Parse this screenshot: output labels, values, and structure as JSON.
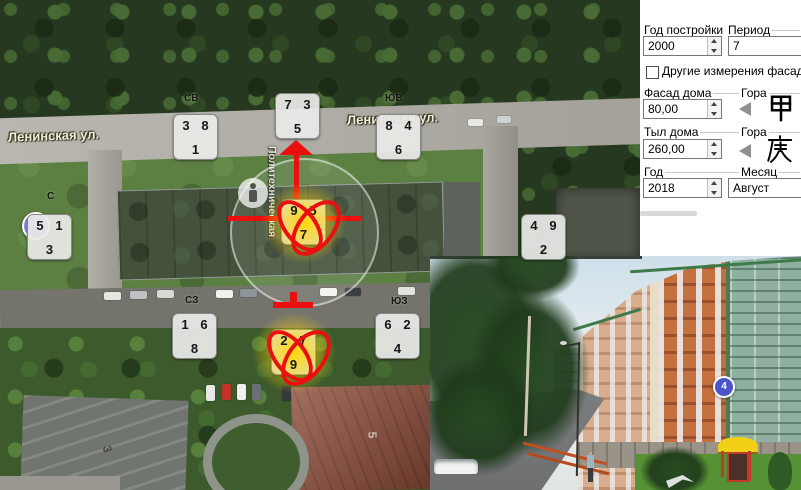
{
  "panel": {
    "year_built": {
      "label": "Год постройки",
      "value": "2000"
    },
    "period": {
      "label": "Период",
      "value": "7"
    },
    "other_measurements": {
      "label": "Другие измерения фасада",
      "checked": false
    },
    "facade": {
      "label": "Фасад дома",
      "value": "80,00"
    },
    "facade_mountain": {
      "label": "Гора",
      "hanzi": "甲"
    },
    "rear": {
      "label": "Тыл дома",
      "value": "260,00"
    },
    "rear_mountain": {
      "label": "Гора",
      "hanzi": "庚"
    },
    "year": {
      "label": "Год",
      "value": "2018"
    },
    "month": {
      "label": "Месяц",
      "value": "Август"
    }
  },
  "map": {
    "street_labels": {
      "left": "Ленинская ул.",
      "right": "Ленинская ул.",
      "vertical": "Политехническая"
    },
    "house_numbers": {
      "left": "3",
      "right": "5"
    },
    "sector_labels": [
      {
        "text": "СВ",
        "x": 184,
        "y": 93
      },
      {
        "text": "ЮВ",
        "x": 385,
        "y": 93
      },
      {
        "text": "С",
        "x": 47,
        "y": 191
      },
      {
        "text": "СЗ",
        "x": 185,
        "y": 295
      },
      {
        "text": "ЮЗ",
        "x": 391,
        "y": 296
      }
    ],
    "star_grids": [
      {
        "tl": "3",
        "tr": "8",
        "b": "1",
        "x": 173,
        "y": 114,
        "highlighted": false
      },
      {
        "tl": "7",
        "tr": "3",
        "b": "5",
        "x": 275,
        "y": 93,
        "highlighted": false
      },
      {
        "tl": "8",
        "tr": "4",
        "b": "6",
        "x": 376,
        "y": 114,
        "highlighted": false
      },
      {
        "tl": "5",
        "tr": "1",
        "b": "3",
        "x": 27,
        "y": 214,
        "highlighted": false
      },
      {
        "tl": "9",
        "tr": "5",
        "b": "7",
        "x": 281,
        "y": 199,
        "highlighted": true
      },
      {
        "tl": "4",
        "tr": "9",
        "b": "2",
        "x": 521,
        "y": 214,
        "highlighted": false
      },
      {
        "tl": "1",
        "tr": "6",
        "b": "8",
        "x": 172,
        "y": 313,
        "highlighted": false
      },
      {
        "tl": "2",
        "tr": "7",
        "b": "9",
        "x": 271,
        "y": 329,
        "highlighted": true
      },
      {
        "tl": "6",
        "tr": "2",
        "b": "4",
        "x": 375,
        "y": 313,
        "highlighted": false
      }
    ]
  },
  "photo": {
    "marker_label": "4"
  },
  "colors": {
    "annotation_red": "#ea1010",
    "highlight_yellow": "#ffd600",
    "marker_blue": "#4b55c9",
    "grid_bg": "#e9e9e7"
  }
}
